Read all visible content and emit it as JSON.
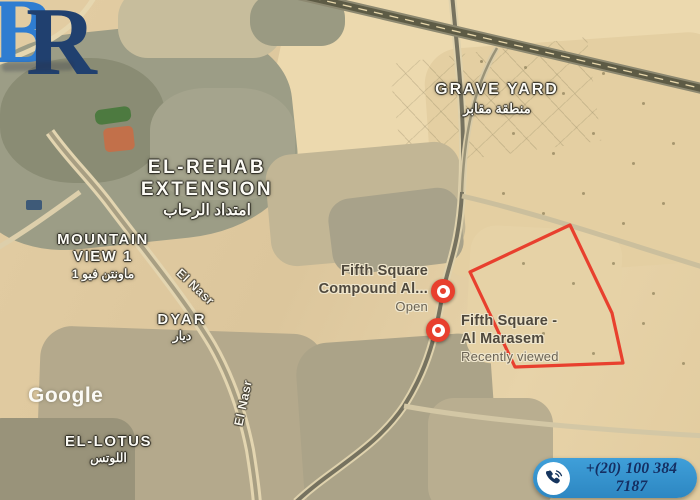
{
  "logo": {
    "letter_b": "B",
    "letter_r": "R"
  },
  "watermark": {
    "text": "Google"
  },
  "map_labels": {
    "grave_yard": {
      "en": "GRAVE YARD",
      "ar": "منطقة مقابر"
    },
    "el_rehab": {
      "line1": "EL-REHAB",
      "line2": "EXTENSION",
      "ar": "امتداد الرحاب"
    },
    "mountain_view": {
      "line1": "MOUNTAIN",
      "line2": "VIEW 1",
      "ar": "ماونتن فيو 1"
    },
    "dyar": {
      "en": "DYAR",
      "ar": "ديار"
    },
    "el_lotus": {
      "en": "EL-LOTUS",
      "ar": "اللوتس"
    },
    "roads": {
      "el_nasr_upper": "El Nasr",
      "el_nasr_lower": "El Nasr"
    }
  },
  "places": [
    {
      "name_line1": "Fifth Square",
      "name_line2": "Compound Al...",
      "status": "Open"
    },
    {
      "name_line1": "Fifth Square -",
      "name_line2": "Al Marasem",
      "status": "Recently viewed"
    }
  ],
  "contact": {
    "phone": "+(20) 100 384 7187"
  },
  "colors": {
    "marker_red": "#e8402e",
    "polygon_red": "#e8402e",
    "phone_pill": "#3f9fd9",
    "phone_pill_dark": "#2d87c2",
    "phone_text": "#152f63",
    "logo_b": "#2f7dd1",
    "logo_r": "#20406f",
    "label_white": "#fcfbf5",
    "place_label": "#4f483c"
  }
}
